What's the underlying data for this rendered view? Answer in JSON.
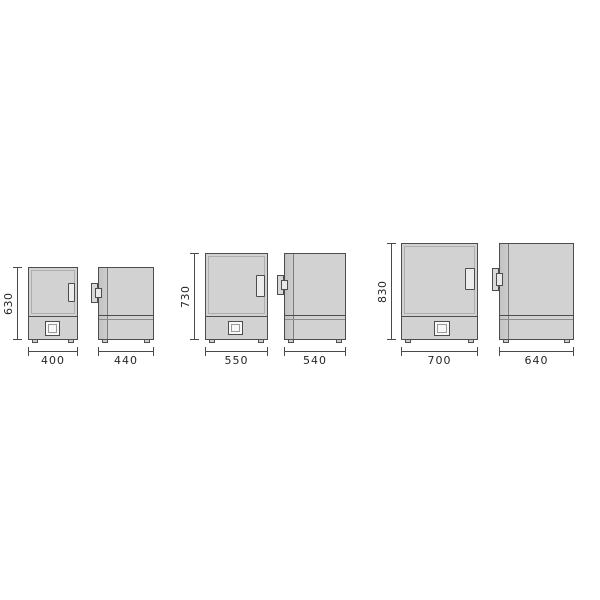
{
  "colors": {
    "body_fill": "#d2d2d2",
    "outline": "#4d4d4d",
    "dimension_line": "#4a4a4a",
    "background": "#ffffff"
  },
  "diagram": {
    "pairs": [
      {
        "size": "small",
        "height": "630",
        "front_width": "400",
        "side_depth": "440"
      },
      {
        "size": "medium",
        "height": "730",
        "front_width": "550",
        "side_depth": "540"
      },
      {
        "size": "large",
        "height": "830",
        "front_width": "700",
        "side_depth": "640"
      }
    ]
  }
}
